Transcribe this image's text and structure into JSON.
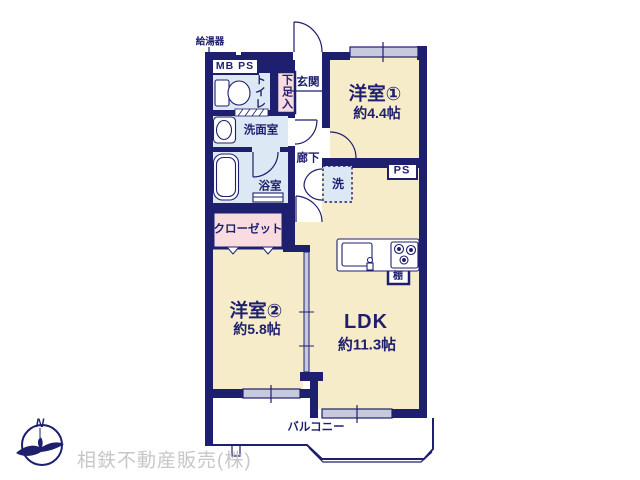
{
  "plan": {
    "labels": {
      "water_heater": "給湯器",
      "mb_ps": "MB PS",
      "entrance": "玄関",
      "shoe_cabinet": "下足入",
      "toilet": "トイレ",
      "washroom": "洗面室",
      "corridor": "廊下",
      "bathroom": "浴室",
      "washer": "洗",
      "ps": "PS",
      "closet": "クローゼット",
      "shelf": "棚",
      "balcony": "バルコニー"
    },
    "rooms": {
      "room1": {
        "name": "洋室①",
        "size": "約4.4帖"
      },
      "room2": {
        "name": "洋室②",
        "size": "約5.8帖"
      },
      "ldk": {
        "name": "LDK",
        "size": "約11.3帖"
      }
    },
    "colors": {
      "wall_navy": "#1e1f6e",
      "room_cream": "#f6ecca",
      "wet_blue": "#dce8f3",
      "closet_pink": "#f8dce0",
      "window_lavender": "#c7cadf",
      "company_gray": "#c7c7c9"
    }
  },
  "footer": {
    "compass_n": "N",
    "company": "相鉄不動産販売(株)"
  }
}
